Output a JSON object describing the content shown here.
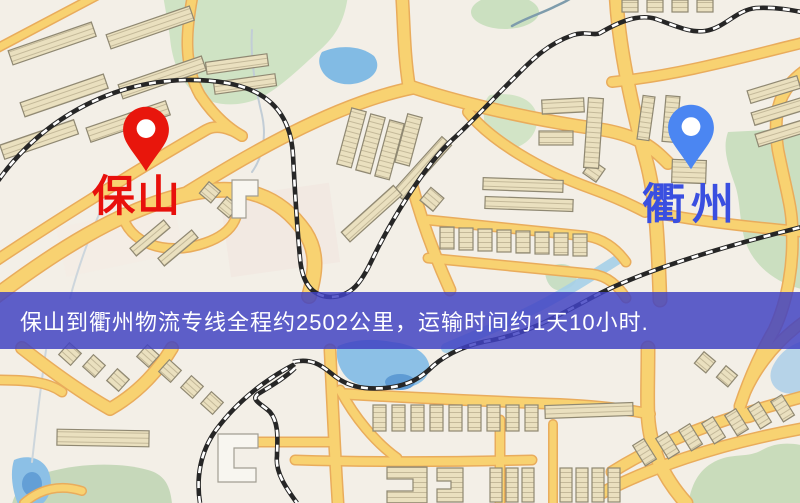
{
  "banner": {
    "text": "保山到衢州物流专线全程约2502公里，运输时间约1天10小时.",
    "background_rgba": "rgba(64,66,194,0.84)",
    "text_color": "#FFFFFF"
  },
  "pins": {
    "origin": {
      "label": "保山",
      "pin_color": "#E8160C",
      "label_color": "#E8100C"
    },
    "destination": {
      "label": "衢州",
      "pin_color": "#4B86F2",
      "label_color": "#3A4FE0"
    }
  },
  "map": {
    "background": "#F3EFE7",
    "road_fill": "#F8D271",
    "road_border": "#E9AC5C",
    "railway_dark": "#262626",
    "water": "#8CC0E6",
    "park": "#CBDFC0",
    "building": "#EAE0BF"
  }
}
